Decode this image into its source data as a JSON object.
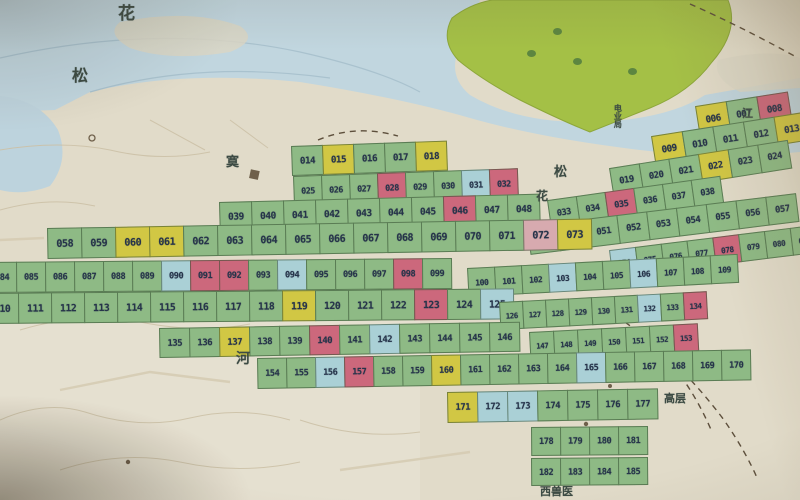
{
  "meta": {
    "description": "Photograph of a paper city map with numbered map-sheet index grid"
  },
  "palette": {
    "paper": "#e4decа",
    "water": "#c2d9e3",
    "water_deep": "#b7d2de",
    "park": "#a4c33c",
    "cell_green": "#8cbd82",
    "cell_yellow": "#d5ca39",
    "cell_pink": "#d4667c",
    "cell_lightpink": "#dcabb0",
    "cell_blue": "#a9d3da",
    "cell_border": "#2c4828",
    "number_ink": "#22324a",
    "label_ink": "#3a4a42"
  },
  "labels": [
    {
      "text": "花",
      "x": 118,
      "y": 6,
      "size": 17
    },
    {
      "text": "松",
      "x": 72,
      "y": 68,
      "size": 16
    },
    {
      "text": "寞",
      "x": 226,
      "y": 156,
      "size": 13
    },
    {
      "text": "松",
      "x": 554,
      "y": 166,
      "size": 13
    },
    {
      "text": "花",
      "x": 536,
      "y": 190,
      "size": 12
    },
    {
      "text": "江",
      "x": 742,
      "y": 108,
      "size": 11
    },
    {
      "text": "河",
      "x": 236,
      "y": 352,
      "size": 14
    },
    {
      "text": "高层",
      "x": 664,
      "y": 393,
      "size": 11
    },
    {
      "text": "西兽医",
      "x": 540,
      "y": 486,
      "size": 11
    },
    {
      "text": "电业局",
      "x": 614,
      "y": 104,
      "size": 8,
      "vertical": true
    }
  ],
  "trees": [
    {
      "x": 527,
      "y": 50
    },
    {
      "x": 573,
      "y": 58
    },
    {
      "x": 628,
      "y": 68
    },
    {
      "x": 553,
      "y": 28
    }
  ],
  "grid": {
    "segments": [
      {
        "x": 696,
        "y": 106,
        "w": 32,
        "h": 30,
        "rot": -9,
        "cells": [
          {
            "n": "006",
            "c": "y"
          },
          {
            "n": "007",
            "c": "g"
          },
          {
            "n": "008",
            "c": "p"
          }
        ]
      },
      {
        "x": 652,
        "y": 136,
        "w": 32,
        "h": 29,
        "rot": -9,
        "cells": [
          {
            "n": "009",
            "c": "y"
          },
          {
            "n": "010",
            "c": "g"
          },
          {
            "n": "011",
            "c": "g"
          },
          {
            "n": "012",
            "c": "g"
          },
          {
            "n": "013",
            "c": "y"
          }
        ]
      },
      {
        "x": 292,
        "y": 146,
        "w": 32,
        "h": 30,
        "rot": -2,
        "cells": [
          {
            "n": "014",
            "c": "g"
          },
          {
            "n": "015",
            "c": "y"
          },
          {
            "n": "016",
            "c": "g"
          },
          {
            "n": "017",
            "c": "g"
          },
          {
            "n": "018",
            "c": "y"
          }
        ]
      },
      {
        "x": 610,
        "y": 168,
        "w": 31,
        "h": 29,
        "rot": -9,
        "cells": [
          {
            "n": "019",
            "c": "g"
          },
          {
            "n": "020",
            "c": "g"
          },
          {
            "n": "021",
            "c": "g"
          },
          {
            "n": "022",
            "c": "y"
          },
          {
            "n": "023",
            "c": "g"
          },
          {
            "n": "024",
            "c": "g"
          }
        ]
      },
      {
        "x": 294,
        "y": 176,
        "w": 29,
        "h": 29,
        "rot": -2,
        "cells": [
          {
            "n": "025",
            "c": "g"
          },
          {
            "n": "026",
            "c": "g"
          },
          {
            "n": "027",
            "c": "g"
          },
          {
            "n": "028",
            "c": "p"
          },
          {
            "n": "029",
            "c": "g"
          },
          {
            "n": "030",
            "c": "g"
          },
          {
            "n": "031",
            "c": "b"
          },
          {
            "n": "032",
            "c": "p"
          }
        ]
      },
      {
        "x": 548,
        "y": 200,
        "w": 30,
        "h": 28,
        "rot": -8,
        "cells": [
          {
            "n": "033",
            "c": "g"
          },
          {
            "n": "034",
            "c": "g"
          },
          {
            "n": "035",
            "c": "p"
          },
          {
            "n": "036",
            "c": "g"
          },
          {
            "n": "037",
            "c": "g"
          },
          {
            "n": "038",
            "c": "g"
          }
        ]
      },
      {
        "x": 220,
        "y": 202,
        "w": 33,
        "h": 30,
        "rot": -1.5,
        "cells": [
          {
            "n": "039",
            "c": "g"
          },
          {
            "n": "040",
            "c": "g"
          },
          {
            "n": "041",
            "c": "g"
          },
          {
            "n": "042",
            "c": "g"
          },
          {
            "n": "043",
            "c": "g"
          },
          {
            "n": "044",
            "c": "g"
          },
          {
            "n": "045",
            "c": "g"
          },
          {
            "n": "046",
            "c": "p"
          },
          {
            "n": "047",
            "c": "g"
          },
          {
            "n": "048",
            "c": "g"
          }
        ]
      },
      {
        "x": 528,
        "y": 226,
        "w": 31,
        "h": 29,
        "rot": -7,
        "cells": [
          {
            "n": "049",
            "c": "g"
          },
          {
            "n": "050",
            "c": "g"
          },
          {
            "n": "051",
            "c": "g"
          },
          {
            "n": "052",
            "c": "g"
          },
          {
            "n": "053",
            "c": "g"
          },
          {
            "n": "054",
            "c": "g"
          },
          {
            "n": "055",
            "c": "g"
          },
          {
            "n": "056",
            "c": "g"
          },
          {
            "n": "057",
            "c": "g"
          }
        ]
      },
      {
        "x": 48,
        "y": 228,
        "w": 35,
        "h": 31,
        "rot": -1,
        "cells": [
          {
            "n": "058",
            "c": "g"
          },
          {
            "n": "059",
            "c": "g"
          },
          {
            "n": "060",
            "c": "y"
          },
          {
            "n": "061",
            "c": "y"
          },
          {
            "n": "062",
            "c": "g"
          },
          {
            "n": "063",
            "c": "g"
          },
          {
            "n": "064",
            "c": "g"
          },
          {
            "n": "065",
            "c": "g"
          },
          {
            "n": "066",
            "c": "g"
          },
          {
            "n": "067",
            "c": "g"
          },
          {
            "n": "068",
            "c": "g"
          },
          {
            "n": "069",
            "c": "g"
          },
          {
            "n": "070",
            "c": "g"
          },
          {
            "n": "071",
            "c": "g"
          },
          {
            "n": "072",
            "c": "lp"
          },
          {
            "n": "073",
            "c": "y"
          }
        ]
      },
      {
        "x": 610,
        "y": 250,
        "w": 27,
        "h": 28,
        "rot": -7,
        "cells": [
          {
            "n": "074",
            "c": "b"
          },
          {
            "n": "075",
            "c": "g"
          },
          {
            "n": "076",
            "c": "g"
          },
          {
            "n": "077",
            "c": "g"
          },
          {
            "n": "078",
            "c": "p"
          },
          {
            "n": "079",
            "c": "g"
          },
          {
            "n": "080",
            "c": "g"
          },
          {
            "n": "081",
            "c": "g"
          },
          {
            "n": "082",
            "c": "g"
          },
          {
            "n": "083",
            "c": "g"
          }
        ]
      },
      {
        "x": -12,
        "y": 262,
        "w": 30,
        "h": 31,
        "rot": -0.5,
        "cells": [
          {
            "n": "084",
            "c": "g"
          },
          {
            "n": "085",
            "c": "g"
          },
          {
            "n": "086",
            "c": "g"
          },
          {
            "n": "087",
            "c": "g"
          },
          {
            "n": "088",
            "c": "g"
          },
          {
            "n": "089",
            "c": "g"
          },
          {
            "n": "090",
            "c": "b"
          },
          {
            "n": "091",
            "c": "p"
          },
          {
            "n": "092",
            "c": "p"
          },
          {
            "n": "093",
            "c": "g"
          },
          {
            "n": "094",
            "c": "b"
          },
          {
            "n": "095",
            "c": "g"
          },
          {
            "n": "096",
            "c": "g"
          },
          {
            "n": "097",
            "c": "g"
          },
          {
            "n": "098",
            "c": "p"
          },
          {
            "n": "099",
            "c": "g"
          }
        ]
      },
      {
        "x": 468,
        "y": 268,
        "w": 28,
        "h": 29,
        "rot": -3,
        "cells": [
          {
            "n": "100",
            "c": "g"
          },
          {
            "n": "101",
            "c": "g"
          },
          {
            "n": "102",
            "c": "g"
          },
          {
            "n": "103",
            "c": "b"
          },
          {
            "n": "104",
            "c": "g"
          },
          {
            "n": "105",
            "c": "g"
          },
          {
            "n": "106",
            "c": "b"
          },
          {
            "n": "107",
            "c": "g"
          },
          {
            "n": "108",
            "c": "g"
          },
          {
            "n": "109",
            "c": "g"
          }
        ]
      },
      {
        "x": -14,
        "y": 293,
        "w": 34,
        "h": 31,
        "rot": -0.5,
        "cells": [
          {
            "n": "110",
            "c": "g"
          },
          {
            "n": "111",
            "c": "g"
          },
          {
            "n": "112",
            "c": "g"
          },
          {
            "n": "113",
            "c": "g"
          },
          {
            "n": "114",
            "c": "g"
          },
          {
            "n": "115",
            "c": "g"
          },
          {
            "n": "116",
            "c": "g"
          },
          {
            "n": "117",
            "c": "g"
          },
          {
            "n": "118",
            "c": "g"
          },
          {
            "n": "119",
            "c": "y"
          },
          {
            "n": "120",
            "c": "g"
          },
          {
            "n": "121",
            "c": "g"
          },
          {
            "n": "122",
            "c": "g"
          },
          {
            "n": "123",
            "c": "p"
          },
          {
            "n": "124",
            "c": "g"
          },
          {
            "n": "125",
            "c": "b"
          }
        ]
      },
      {
        "x": 500,
        "y": 302,
        "w": 24,
        "h": 28,
        "rot": -3,
        "cells": [
          {
            "n": "126",
            "c": "g"
          },
          {
            "n": "127",
            "c": "g"
          },
          {
            "n": "128",
            "c": "g"
          },
          {
            "n": "129",
            "c": "g"
          },
          {
            "n": "130",
            "c": "g"
          },
          {
            "n": "131",
            "c": "g"
          },
          {
            "n": "132",
            "c": "b"
          },
          {
            "n": "133",
            "c": "g"
          },
          {
            "n": "134",
            "c": "p"
          }
        ]
      },
      {
        "x": 160,
        "y": 328,
        "w": 31,
        "h": 30,
        "rot": -1,
        "cells": [
          {
            "n": "135",
            "c": "g"
          },
          {
            "n": "136",
            "c": "g"
          },
          {
            "n": "137",
            "c": "y"
          },
          {
            "n": "138",
            "c": "g"
          },
          {
            "n": "139",
            "c": "g"
          },
          {
            "n": "140",
            "c": "p"
          },
          {
            "n": "141",
            "c": "g"
          },
          {
            "n": "142",
            "c": "b"
          },
          {
            "n": "143",
            "c": "g"
          },
          {
            "n": "144",
            "c": "g"
          },
          {
            "n": "145",
            "c": "g"
          },
          {
            "n": "146",
            "c": "g"
          }
        ]
      },
      {
        "x": 530,
        "y": 332,
        "w": 25,
        "h": 28,
        "rot": -3,
        "cells": [
          {
            "n": "147",
            "c": "g"
          },
          {
            "n": "148",
            "c": "g"
          },
          {
            "n": "149",
            "c": "g"
          },
          {
            "n": "150",
            "c": "g"
          },
          {
            "n": "151",
            "c": "g"
          },
          {
            "n": "152",
            "c": "g"
          },
          {
            "n": "153",
            "c": "p"
          }
        ]
      },
      {
        "x": 258,
        "y": 358,
        "w": 30,
        "h": 31,
        "rot": -1,
        "cells": [
          {
            "n": "154",
            "c": "g"
          },
          {
            "n": "155",
            "c": "g"
          },
          {
            "n": "156",
            "c": "b"
          },
          {
            "n": "157",
            "c": "p"
          },
          {
            "n": "158",
            "c": "g"
          },
          {
            "n": "159",
            "c": "g"
          },
          {
            "n": "160",
            "c": "y"
          },
          {
            "n": "161",
            "c": "g"
          },
          {
            "n": "162",
            "c": "g"
          },
          {
            "n": "163",
            "c": "g"
          },
          {
            "n": "164",
            "c": "g"
          },
          {
            "n": "165",
            "c": "b"
          },
          {
            "n": "166",
            "c": "g"
          },
          {
            "n": "167",
            "c": "g"
          },
          {
            "n": "168",
            "c": "g"
          },
          {
            "n": "169",
            "c": "g"
          },
          {
            "n": "170",
            "c": "g"
          }
        ]
      },
      {
        "x": 448,
        "y": 392,
        "w": 31,
        "h": 31,
        "rot": -1,
        "cells": [
          {
            "n": "171",
            "c": "y"
          },
          {
            "n": "172",
            "c": "b"
          },
          {
            "n": "173",
            "c": "b"
          },
          {
            "n": "174",
            "c": "g"
          },
          {
            "n": "175",
            "c": "g"
          },
          {
            "n": "176",
            "c": "g"
          },
          {
            "n": "177",
            "c": "g"
          }
        ]
      },
      {
        "x": 532,
        "y": 427,
        "w": 30,
        "h": 29,
        "rot": -0.5,
        "cells": [
          {
            "n": "178",
            "c": "g"
          },
          {
            "n": "179",
            "c": "g"
          },
          {
            "n": "180",
            "c": "g"
          },
          {
            "n": "181",
            "c": "g"
          }
        ]
      },
      {
        "x": 532,
        "y": 458,
        "w": 30,
        "h": 28,
        "rot": -0.5,
        "cells": [
          {
            "n": "182",
            "c": "g"
          },
          {
            "n": "183",
            "c": "g"
          },
          {
            "n": "184",
            "c": "g"
          },
          {
            "n": "185",
            "c": "g"
          }
        ]
      }
    ]
  }
}
